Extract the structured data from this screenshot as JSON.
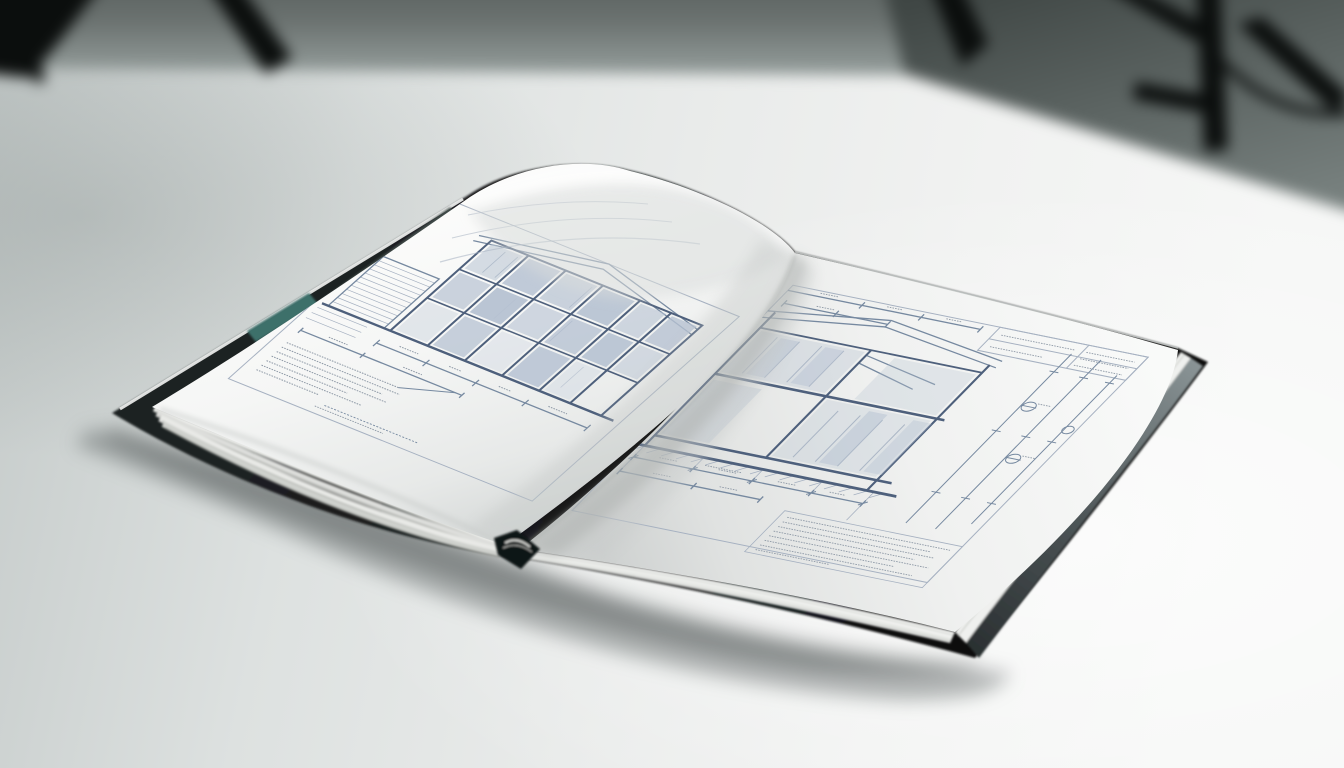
{
  "scene": {
    "objects": {
      "background": "studio-backdrop",
      "stand_left": "tripod-left",
      "stand_right": "tripod-right",
      "surface": "table-surface",
      "subject": "open-architecture-book"
    }
  },
  "colors": {
    "backdrop_top": "#4d5452",
    "backdrop_horizon": "#9aa3a1",
    "backdrop_right": "#3f4644",
    "tripod": "#0b0e0d",
    "table_bright": "#f6f7f6",
    "table_mid": "#e9ebea",
    "table_shaded": "#c2c9c8",
    "book_shadow": "#596160",
    "cover": "#17191a",
    "cover_edge_gloss": "#8a9496",
    "cover_accent_teal": "#3c6f6b",
    "cover_edge_green": "#46534f",
    "spine_dark": "#101213",
    "page_bright": "#fbfcfb",
    "page_mid": "#f1f2f1",
    "page_gutter_shade": "#c4c8c7",
    "stack_fill": "#e7e8e5",
    "stack_line": "#a9aca7",
    "blueprint_line_dark": "#4e607c",
    "blueprint_line_mid": "#7689a0",
    "blueprint_line_light": "#a6b1c1",
    "blueprint_panel": "#b6c2d2",
    "blueprint_panel_light": "#d3dae3",
    "annotation_ink": "#8e99a6"
  }
}
